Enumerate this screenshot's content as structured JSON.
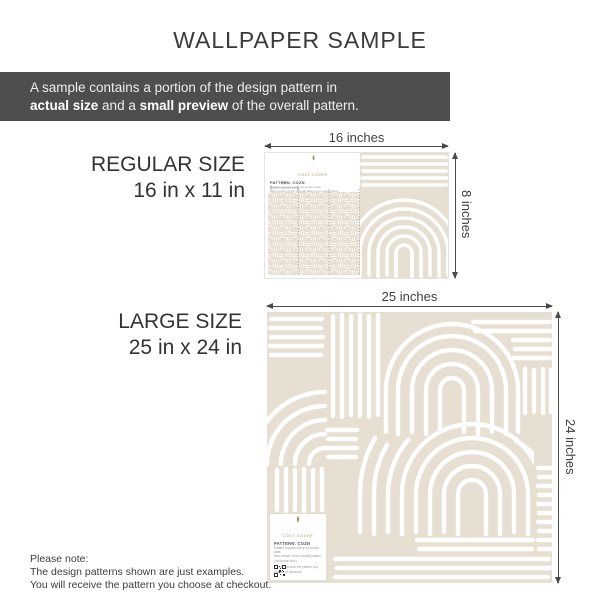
{
  "title": "WALLPAPER SAMPLE",
  "banner": {
    "line1": "A sample contains a portion of the design pattern in",
    "line2": {
      "b1": "actual size",
      "t1": " and a ",
      "b2": "small preview",
      "t2": " of the overall pattern."
    }
  },
  "sections": {
    "regular": {
      "name": "REGULAR SIZE",
      "size": "16 in x 11 in",
      "width_label": "16 inches",
      "height_label": "8 inches"
    },
    "large": {
      "name": "LARGE SIZE",
      "size": "25 in x 24 in",
      "width_label": "25 inches",
      "height_label": "24 inches"
    }
  },
  "sample_card": {
    "brand": "COZY COVER",
    "pattern_name": "PATTERN: COZN",
    "info_line1": "Pattern repeats every 24 inches wide.",
    "info_line2": "Mini version of the overall pattern (not actual size).",
    "info_line3": "You will receive the pattern you choose at checkout.",
    "scale_label": "24\""
  },
  "footer": {
    "line1": "Please note:",
    "line2": "The design patterns shown are just examples.",
    "line3": "You will receive the pattern you choose at checkout."
  },
  "colors": {
    "pattern_beige": "#e7dfd1",
    "stroke_white": "#ffffff",
    "banner_bg": "#4e4e4e",
    "banner_text": "#ededed",
    "heading_text": "#333333",
    "dimension_arrow": "#4a4a4a",
    "brand_gold": "#a89068",
    "cut_guide_gray": "#9b9b9b",
    "qr_dark": "#2f2f2f"
  }
}
